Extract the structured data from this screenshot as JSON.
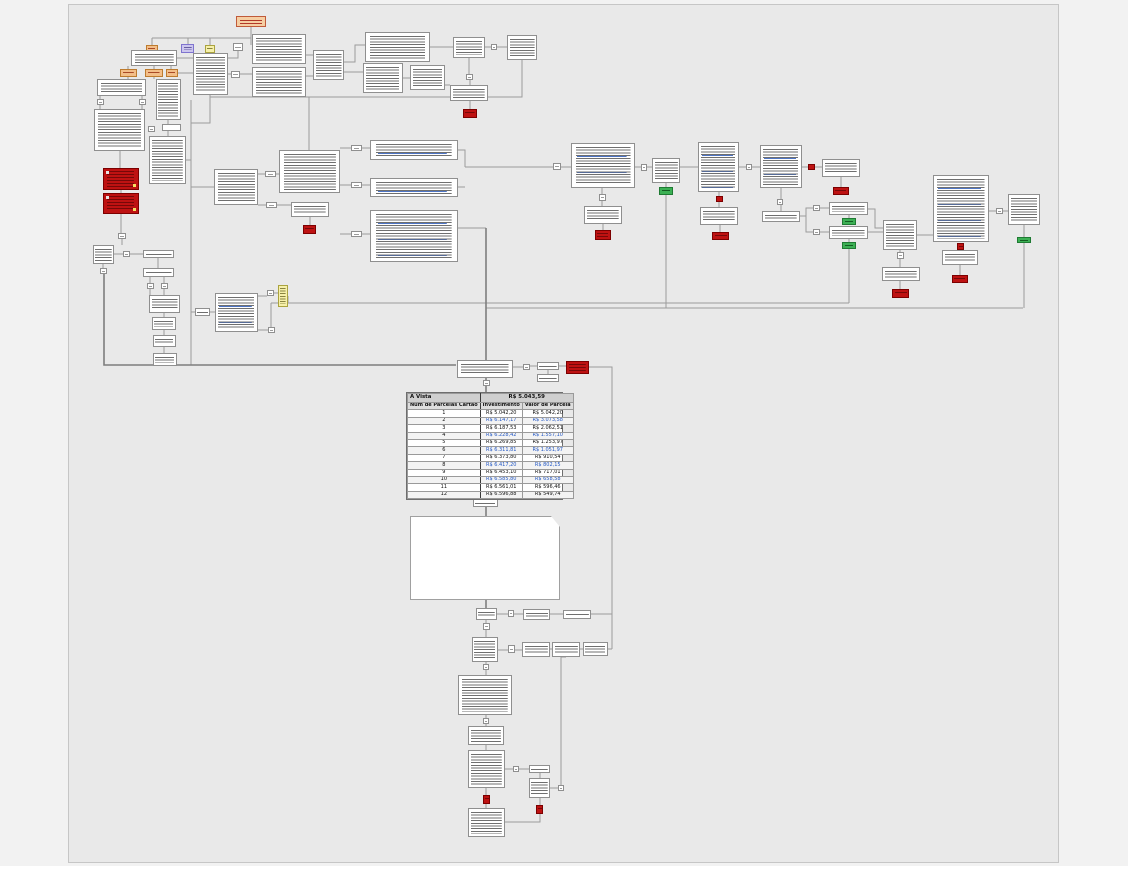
{
  "diagram": {
    "type": "flowchart",
    "language": "pt-BR",
    "canvas_color": "#e9e9e9",
    "node_type_colors": {
      "default_box": "#ffffff",
      "alert_box": "#be1212",
      "success_box": "#3cb054",
      "tag_orange": "#f3be88",
      "start_node": "#f6cea2",
      "tag_purple": "#ccc6ee",
      "tag_yellow": "#f6f0a9",
      "connector_line": "#9c9c9c",
      "hyperlink_text": "#2257c4"
    },
    "counts": {
      "white_text_nodes": 62,
      "alert_boxes": 16,
      "success_boxes": 6,
      "small_connector_squares": 35
    }
  },
  "pricing_table": {
    "cash_label": "A Vista",
    "cash_value": "R$ 5.043,59",
    "columns": [
      "Num de Parcelas Cartão",
      "Investimento",
      "Valor de Parcela"
    ],
    "rows": [
      {
        "n": "1",
        "inv": "R$ 5.042,20",
        "parc": "R$ 5.042,20",
        "link": false
      },
      {
        "n": "2",
        "inv": "R$ 6.147,17",
        "parc": "R$ 3.073,58",
        "link": true
      },
      {
        "n": "3",
        "inv": "R$ 6.187,53",
        "parc": "R$ 2.062,51",
        "link": false
      },
      {
        "n": "4",
        "inv": "R$ 6.228,42",
        "parc": "R$ 1.557,10",
        "link": true
      },
      {
        "n": "5",
        "inv": "R$ 6.269,85",
        "parc": "R$ 1.253,97",
        "link": false
      },
      {
        "n": "6",
        "inv": "R$ 6.311,81",
        "parc": "R$ 1.051,97",
        "link": true
      },
      {
        "n": "7",
        "inv": "R$ 6.373,80",
        "parc": "R$ 910,54",
        "link": false
      },
      {
        "n": "8",
        "inv": "R$ 6.417,20",
        "parc": "R$ 802,15",
        "link": true
      },
      {
        "n": "9",
        "inv": "R$ 6.453,10",
        "parc": "R$ 717,01",
        "link": false
      },
      {
        "n": "10",
        "inv": "R$ 6.585,80",
        "parc": "R$ 658,58",
        "link": true
      },
      {
        "n": "11",
        "inv": "R$ 6.561,01",
        "parc": "R$ 596,46",
        "link": false
      },
      {
        "n": "12",
        "inv": "R$ 6.596,88",
        "parc": "R$ 549,74",
        "link": false
      }
    ]
  }
}
